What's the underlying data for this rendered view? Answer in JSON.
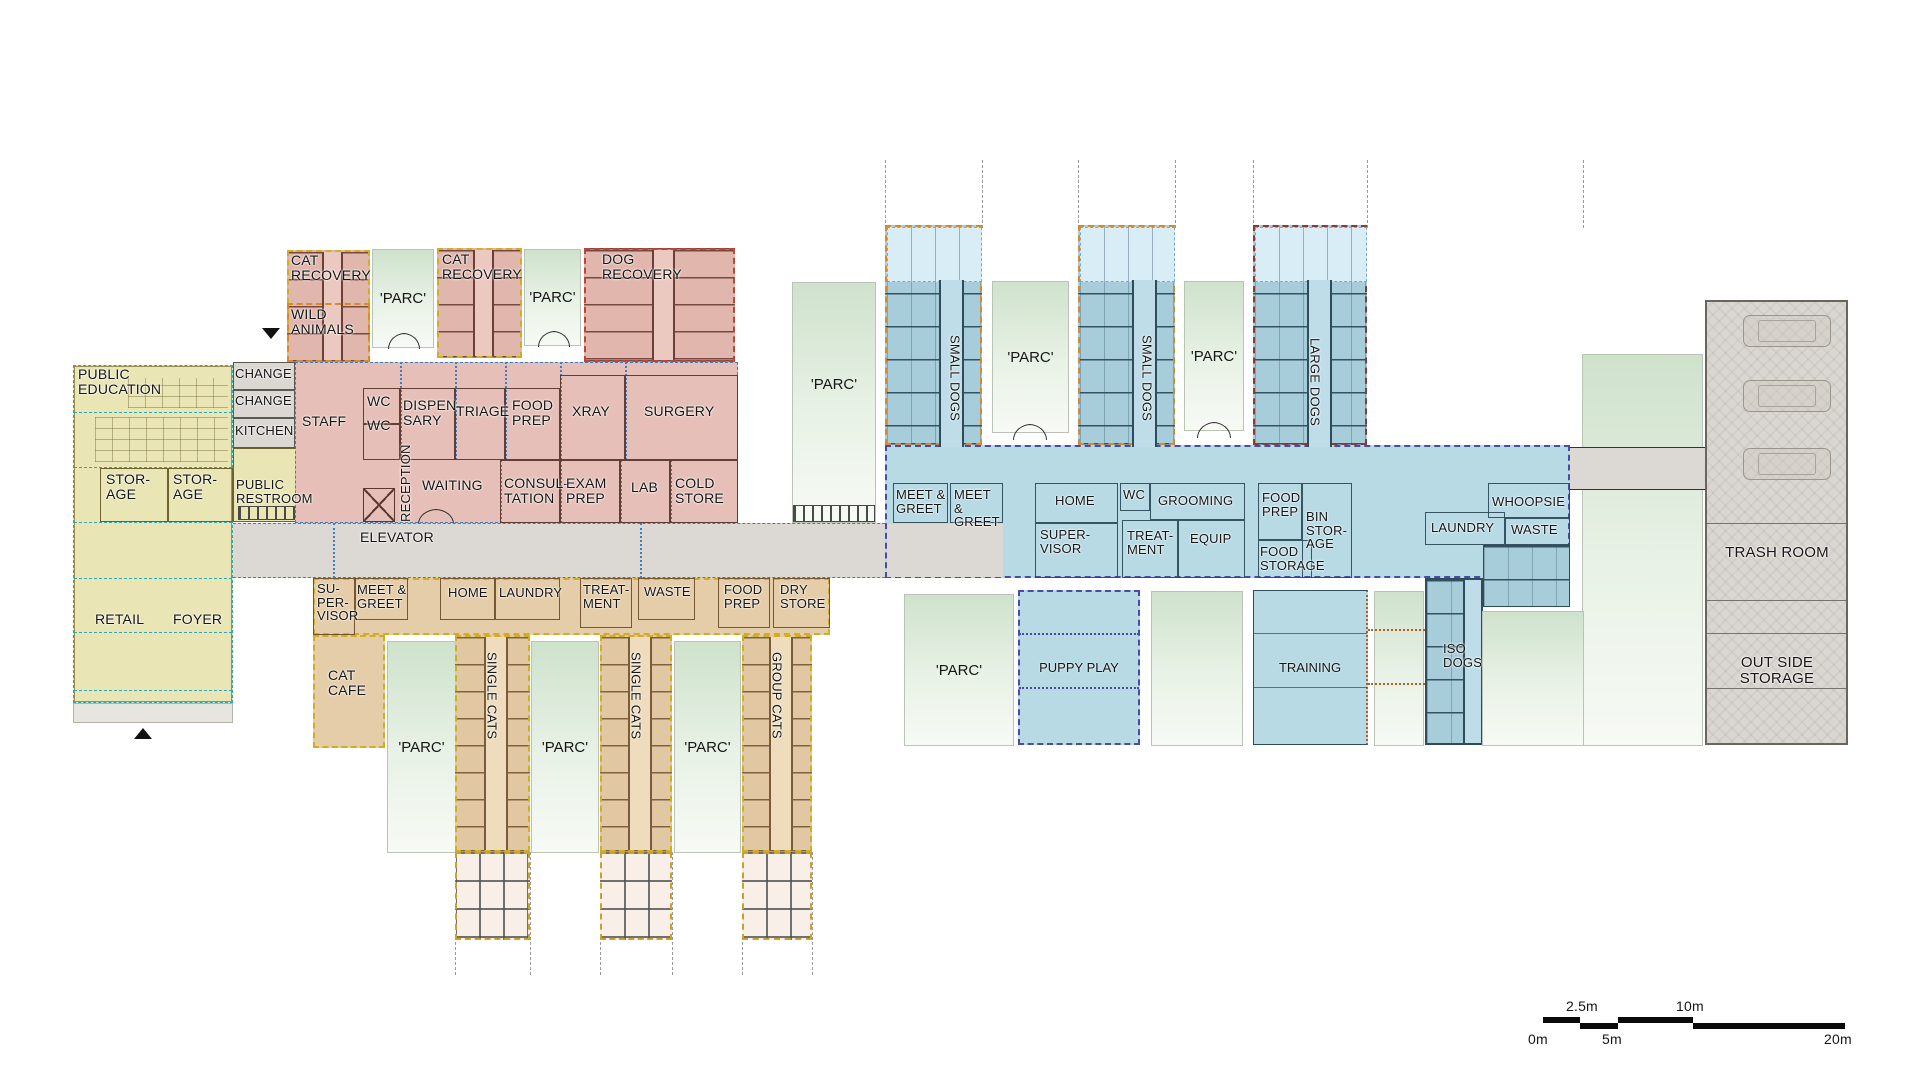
{
  "plan": {
    "public": {
      "education": "PUBLIC EDUCATION",
      "storage": "STOR- AGE",
      "change": "CHANGE",
      "kitchen": "KITCHEN",
      "restroom": "PUBLIC RESTROOM",
      "staff": "STAFF",
      "retail": "RETAIL",
      "foyer": "FOYER"
    },
    "medical": {
      "cat_recovery": "CAT RECOVERY",
      "wild_animals": "WILD ANIMALS",
      "dog_recovery": "DOG RECOVERY",
      "wc": "WC",
      "dispensary": "DISPEN- SARY",
      "triage": "TRIAGE",
      "food_prep": "FOOD PREP",
      "xray": "XRAY",
      "surgery": "SURGERY",
      "reception": "RECEPTION",
      "waiting": "WAITING",
      "consultation": "CONSUL- TATION",
      "exam_prep": "EXAM PREP",
      "lab": "LAB",
      "cold_store": "COLD STORE",
      "elevator": "ELEVATOR"
    },
    "cats": {
      "supervisor": "SU- PER- VISOR",
      "meet_greet": "MEET & GREET",
      "home": "HOME",
      "laundry": "LAUNDRY",
      "treatment": "TREAT- MENT",
      "waste": "WASTE",
      "food_prep": "FOOD PREP",
      "dry_store": "DRY STORE",
      "cat_cafe": "CAT CAFE",
      "single_cats": "SINGLE CATS",
      "group_cats": "GROUP CATS"
    },
    "dogs": {
      "small_dogs": "SMALL DOGS",
      "large_dogs": "LARGE DOGS",
      "meet_greet": "MEET & GREET",
      "home": "HOME",
      "supervisor": "SUPER- VISOR",
      "wc": "WC",
      "grooming": "GROOMING",
      "treatment": "TREAT- MENT",
      "equip": "EQUIP",
      "food_prep": "FOOD PREP",
      "food_storage": "FOOD STORAGE",
      "bin_storage": "BIN STOR- AGE",
      "laundry": "LAUNDRY",
      "waste": "WASTE",
      "whoopsie": "WHOOPSIE",
      "puppy_play": "PUPPY PLAY",
      "training": "TRAINING",
      "iso_dogs": "ISO DOGS"
    },
    "outdoor": {
      "parc": "'PARC'"
    },
    "service": {
      "trash_room": "TRASH ROOM",
      "outside_storage": "OUT SIDE STORAGE"
    },
    "scale_bar": {
      "m0": "0m",
      "m2_5": "2.5m",
      "m5": "5m",
      "m10": "10m",
      "m20": "20m"
    },
    "colors": {
      "public_fill": "#e9e5b4",
      "medical_fill": "#e6c0b8",
      "cats_fill": "#e5cda9",
      "dogs_fill": "#b7dae5",
      "outdoor_fill": "#cfe2cc",
      "service_fill": "#dad6d1",
      "corridor_fill": "#dcd9d4",
      "zone_dash_teal": "#2aa7b8",
      "zone_dash_gold": "#cfae22",
      "zone_dash_orange": "#d9882a",
      "zone_dash_red": "#c04434",
      "zone_dash_navy": "#4a4aa8"
    }
  }
}
